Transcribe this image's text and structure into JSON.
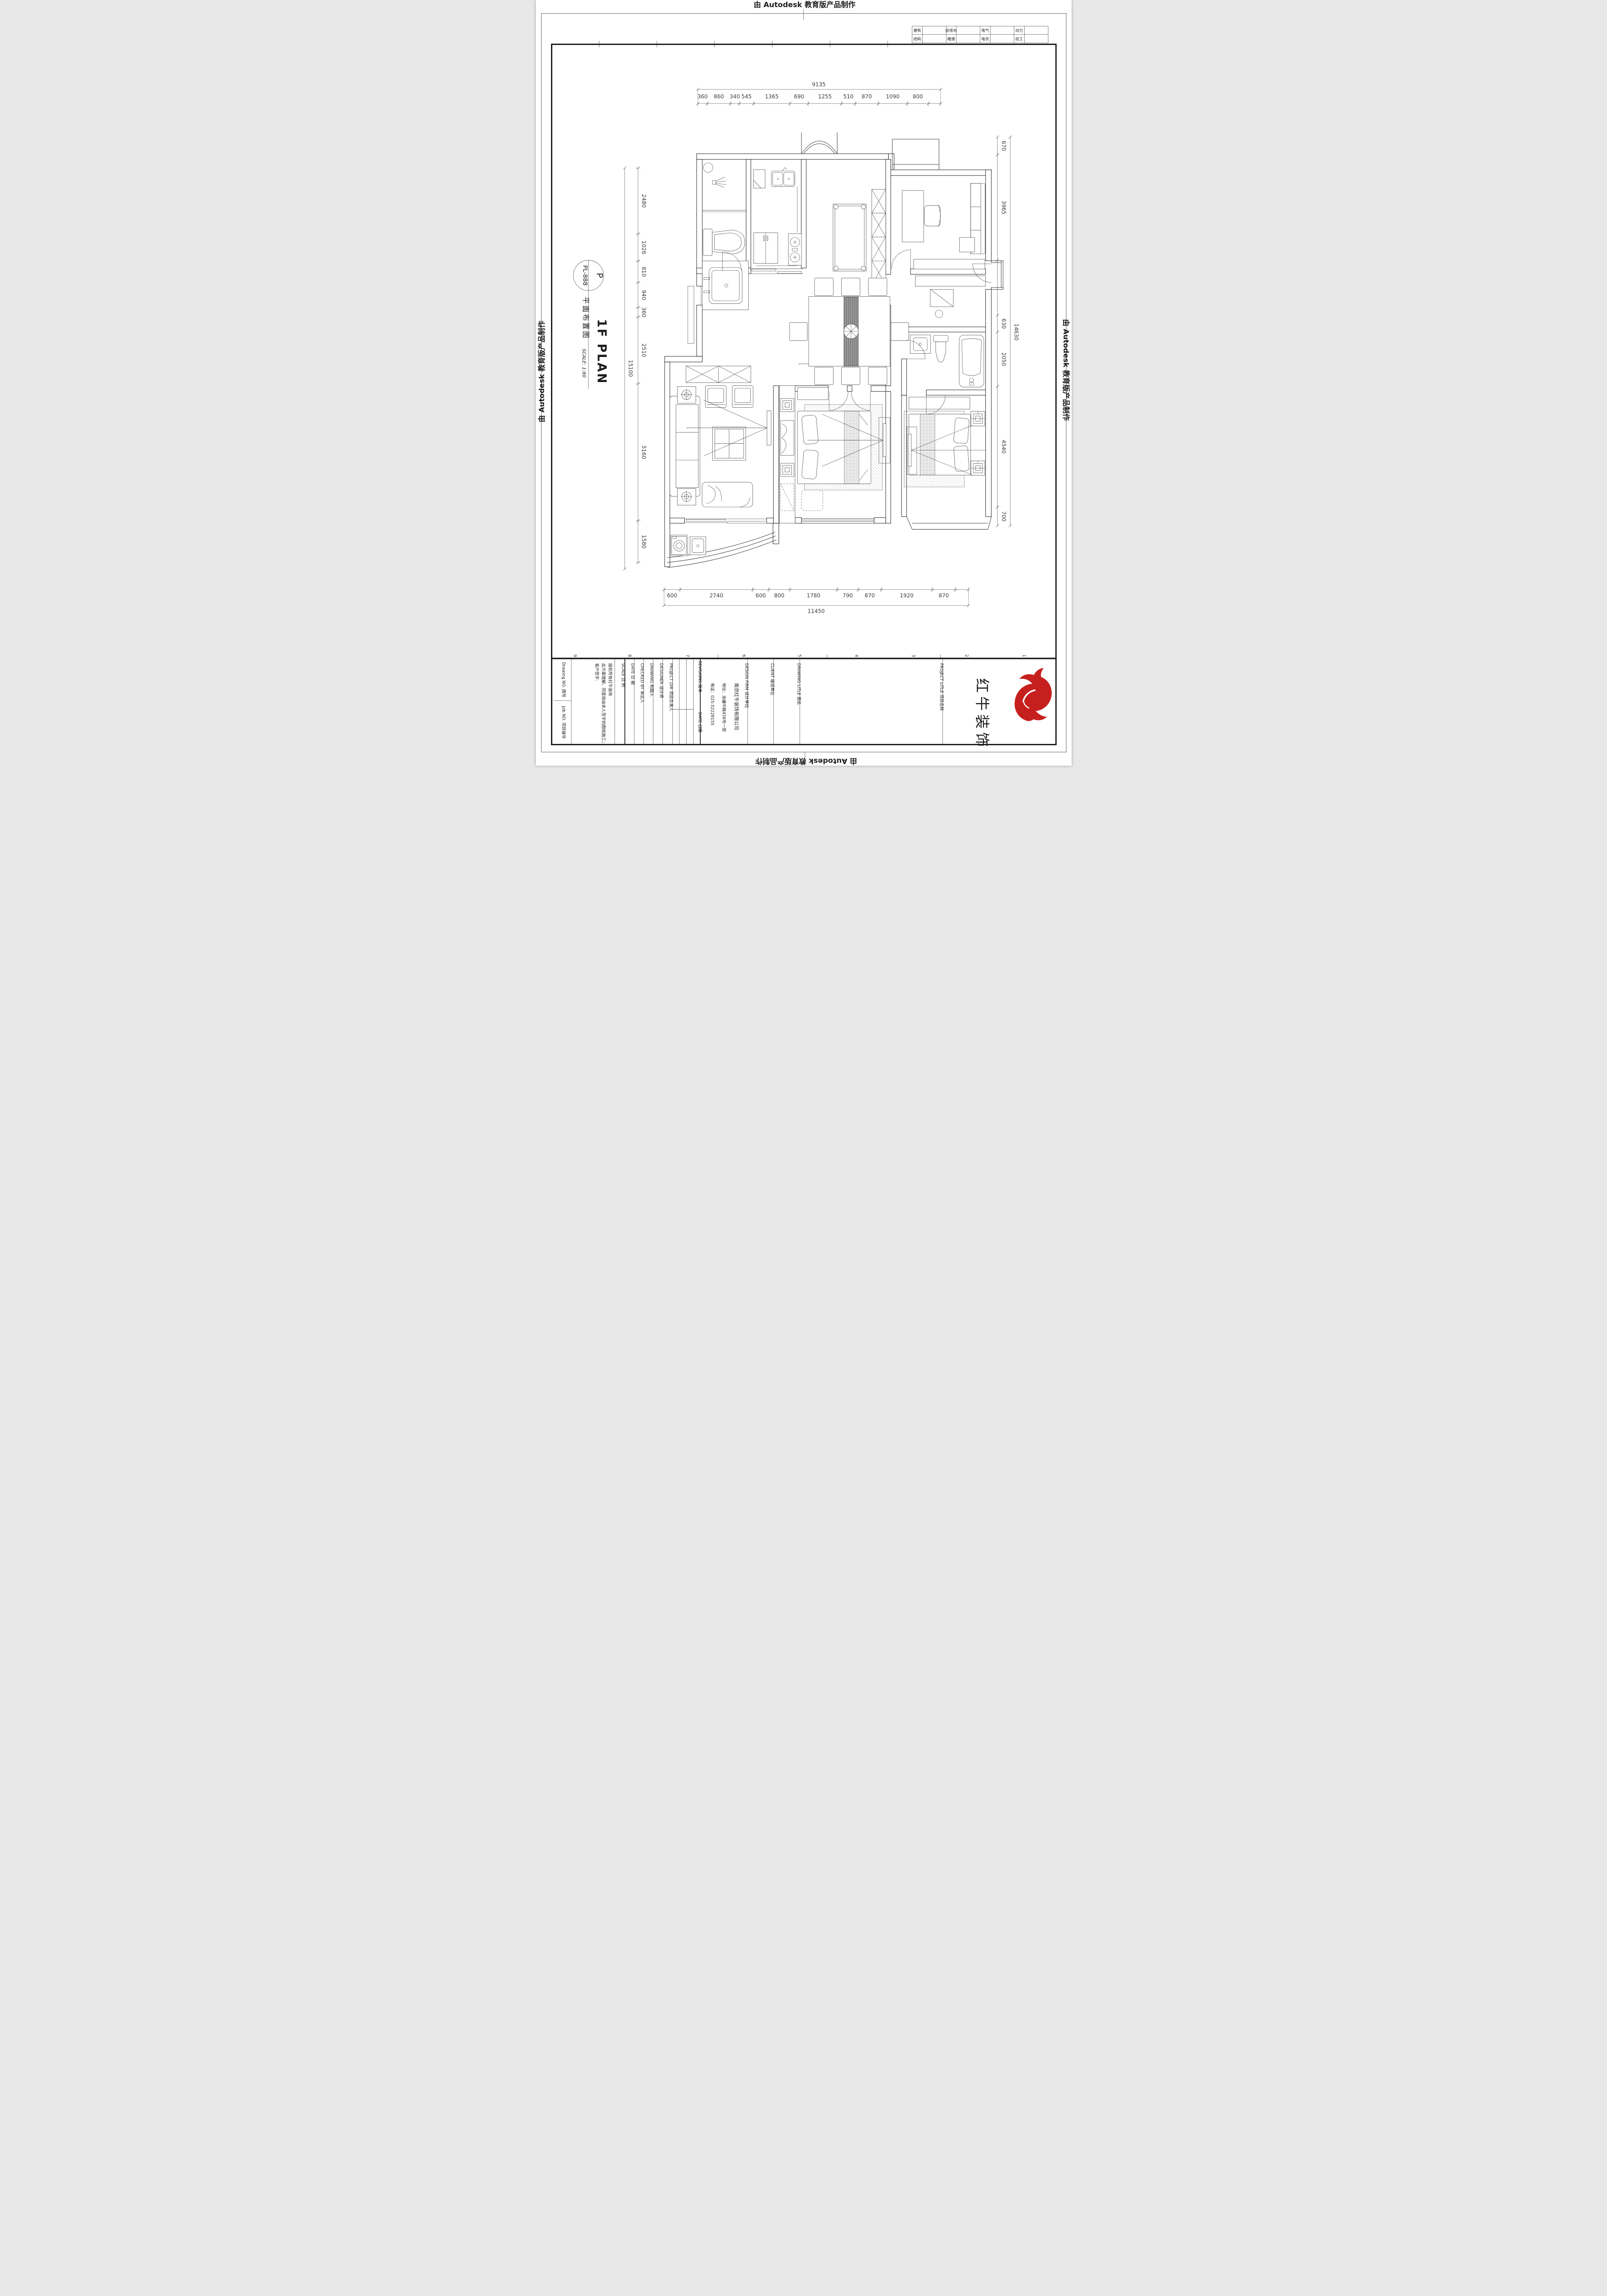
{
  "banner": {
    "text": "由 Autodesk 教育版产品制作"
  },
  "discipline_table": {
    "rows": [
      [
        "建筑",
        "给排水",
        "电气",
        "动力"
      ],
      [
        "结构",
        "暖通",
        "电讯",
        "校工"
      ]
    ]
  },
  "drawing_label": {
    "code_letter": "P",
    "code": "PL-888",
    "title_cn": "平面布置图",
    "title_en": "1F PLAN",
    "scale_note": "SCALE: 1:80"
  },
  "dims": {
    "top": {
      "total": "9135",
      "segments": [
        "360",
        "860",
        "340",
        "545",
        "1365",
        "690",
        "1255",
        "510",
        "870",
        "1090",
        "800"
      ]
    },
    "left": {
      "total": "15100",
      "segments": [
        "2480",
        "1026",
        "810",
        "940",
        "360",
        "2510",
        "5160",
        "1580"
      ]
    },
    "right": {
      "total": "14630",
      "segments": [
        "670",
        "3965",
        "630",
        "2050",
        "4540",
        "700"
      ]
    },
    "bottom": {
      "total": "11450",
      "segments": [
        "600",
        "2740",
        "600",
        "800",
        "1780",
        "790",
        "870",
        "1920",
        "870"
      ]
    }
  },
  "grid_refs": {
    "values": [
      "9",
      "8",
      "7",
      "6",
      "5",
      "4",
      "3",
      "2",
      "1"
    ]
  },
  "title_block": {
    "drawing_no_label": "Drawing NO. 图号",
    "job_no_label": "Job NO. 项目编号",
    "copyright_lines": [
      "版权所有红牛装饰",
      "此方案理解，同意按由本人签字的图纸施工；",
      "客户签字:"
    ],
    "scale_label": "SCALE  比 例",
    "date_label": "DATE  日 期",
    "checked_label": "CHECKED BY  审定人",
    "drawing_label": "DRAWING  制图人",
    "designer_label": "DESIGNER  设计师",
    "project_dir_label": "PROJECT DIR  项目负责人",
    "revisions_label": "REVISIONS  版本",
    "rev_date_label": "DATE 日期",
    "design_firm_label": "DESIGN FIRM  设计单位",
    "firm_lines": [
      "南京红牛装饰有限公司",
      "地址：龙蟠中路458号一层",
      "电话：025-52228155"
    ],
    "client_label": "CLIENT  建设单位",
    "drawing_title_label": "DRAWING LITLE  图名",
    "project_title_label": "PROJECT LITLE  项目名称",
    "logo_text": "红牛装饰",
    "logo_color": "#c6201e"
  }
}
